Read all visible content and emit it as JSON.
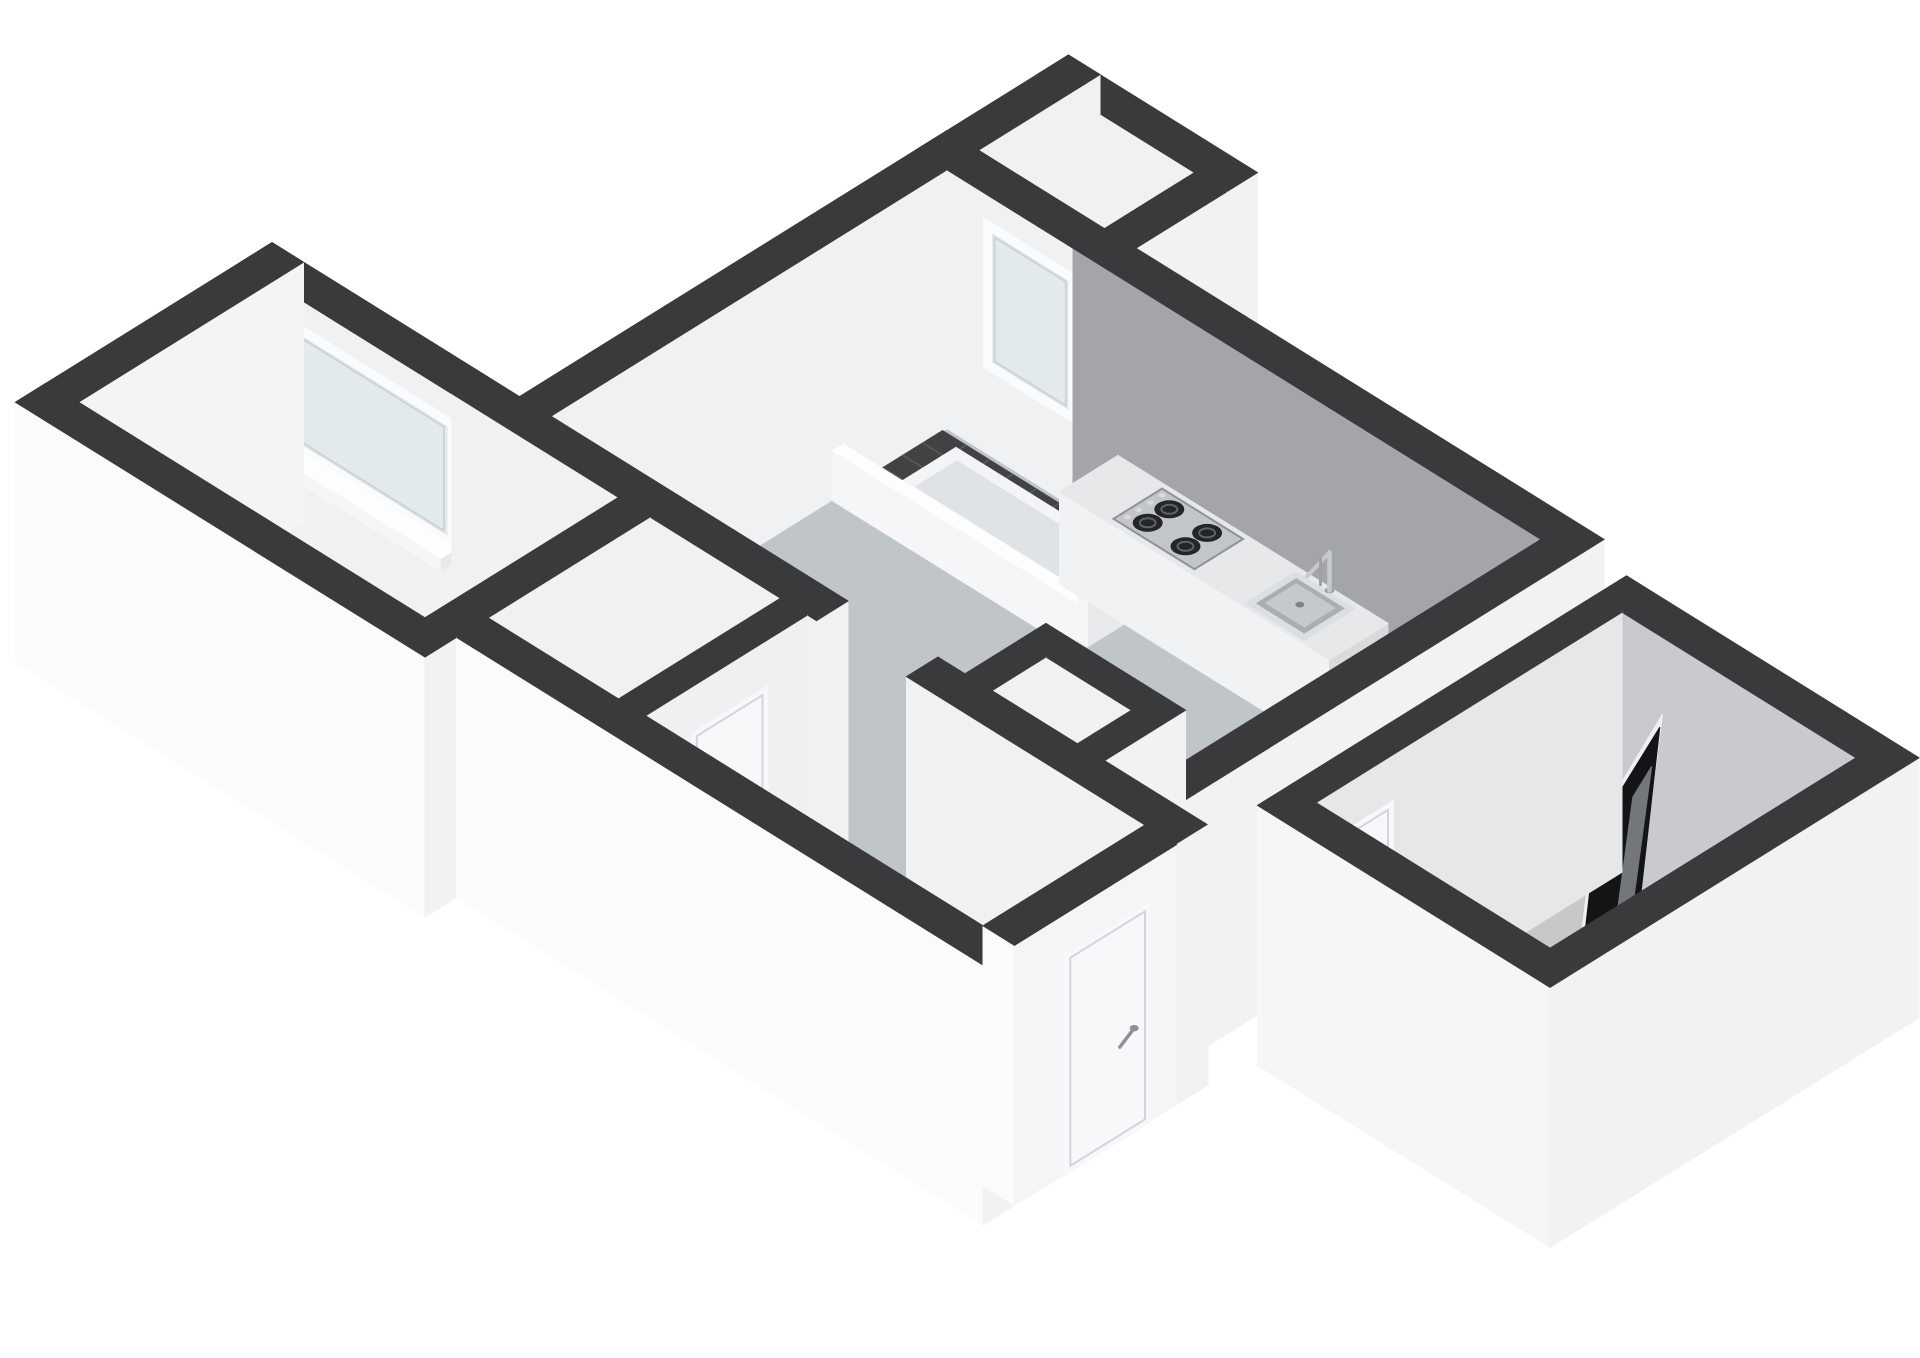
{
  "scene": {
    "description_tag": "isometric-3d-floor-plan",
    "background": "#ffffff",
    "colors": {
      "wall_top": "#3a3a3c",
      "wall_ext_se": "#f2f2f4",
      "wall_ext_sw": "#fbfbfd",
      "wall_int_light": "#f0f1f3",
      "wall_int_gray": "#a4a5a9",
      "wall_int_gray_soft": "#c9cacd",
      "floor_living": "#bfc5c8",
      "floor_bedroom": "#a9c2cc",
      "floor_bath": "#c7c8ca",
      "floor_hall": "#ededef",
      "floor_closet": "#f0f1f2",
      "floor_stub": "#d8d9db",
      "tile_dark": "#424244",
      "tile_grid": "#5a5b5d",
      "tray_rim": "#f3f4f5",
      "tray_inner": "#e0e3e5",
      "glass": "#e3eaed",
      "frame_white": "#fafbfc",
      "sill_top": "#fdfdfe",
      "sill_se": "#e8e9eb",
      "sill_sw": "#f6f6f8",
      "counter_top": "#e7e8ea",
      "counter_se": "#d8dadc",
      "counter_sw": "#f1f2f3",
      "stove_plate": "#c2c6c9",
      "stove_edge": "#8f9296",
      "burner": "#232527",
      "burner_ring": "#606265",
      "knob": "#d8dadc",
      "sink_rim": "#dcdfe1",
      "sink_mid": "#a9aeb1",
      "sink_basin": "#c5c9cc",
      "sink_drain": "#7e8285",
      "chrome": "#c6cacd",
      "chrome_dark": "#9da1a4",
      "door_panel": "#f7f8fa",
      "door_frame": "#d4d5d8",
      "handle": "#8e9194",
      "shower_glass": "#141416",
      "shower_glass_hl": "#73767a",
      "shower_rim": "#eef0f1",
      "ledge_top": "#dadbdd",
      "ledge_se": "#c6c7ca",
      "bottle_dark": "#26262c",
      "bottle_cap": "#c96b3a"
    },
    "rooms": [
      {
        "name": "living-room-kitchen"
      },
      {
        "name": "bedroom"
      },
      {
        "name": "bathroom"
      },
      {
        "name": "entry-hall"
      },
      {
        "name": "meter-closet"
      },
      {
        "name": "balcony-alcove"
      }
    ],
    "fixtures": [
      {
        "name": "gas-hob-4-burner"
      },
      {
        "name": "kitchen-sink"
      },
      {
        "name": "kitchen-faucet"
      },
      {
        "name": "kitchen-counter"
      },
      {
        "name": "shower-glass-panel"
      },
      {
        "name": "shower-drain"
      },
      {
        "name": "bathroom-ledge"
      },
      {
        "name": "balcony-tiles"
      },
      {
        "name": "skylight-tray"
      },
      {
        "name": "meter-closet-bottles"
      },
      {
        "name": "front-door"
      },
      {
        "name": "hall-interior-door"
      },
      {
        "name": "bathroom-door"
      },
      {
        "name": "bedroom-window"
      },
      {
        "name": "living-room-window"
      }
    ]
  }
}
